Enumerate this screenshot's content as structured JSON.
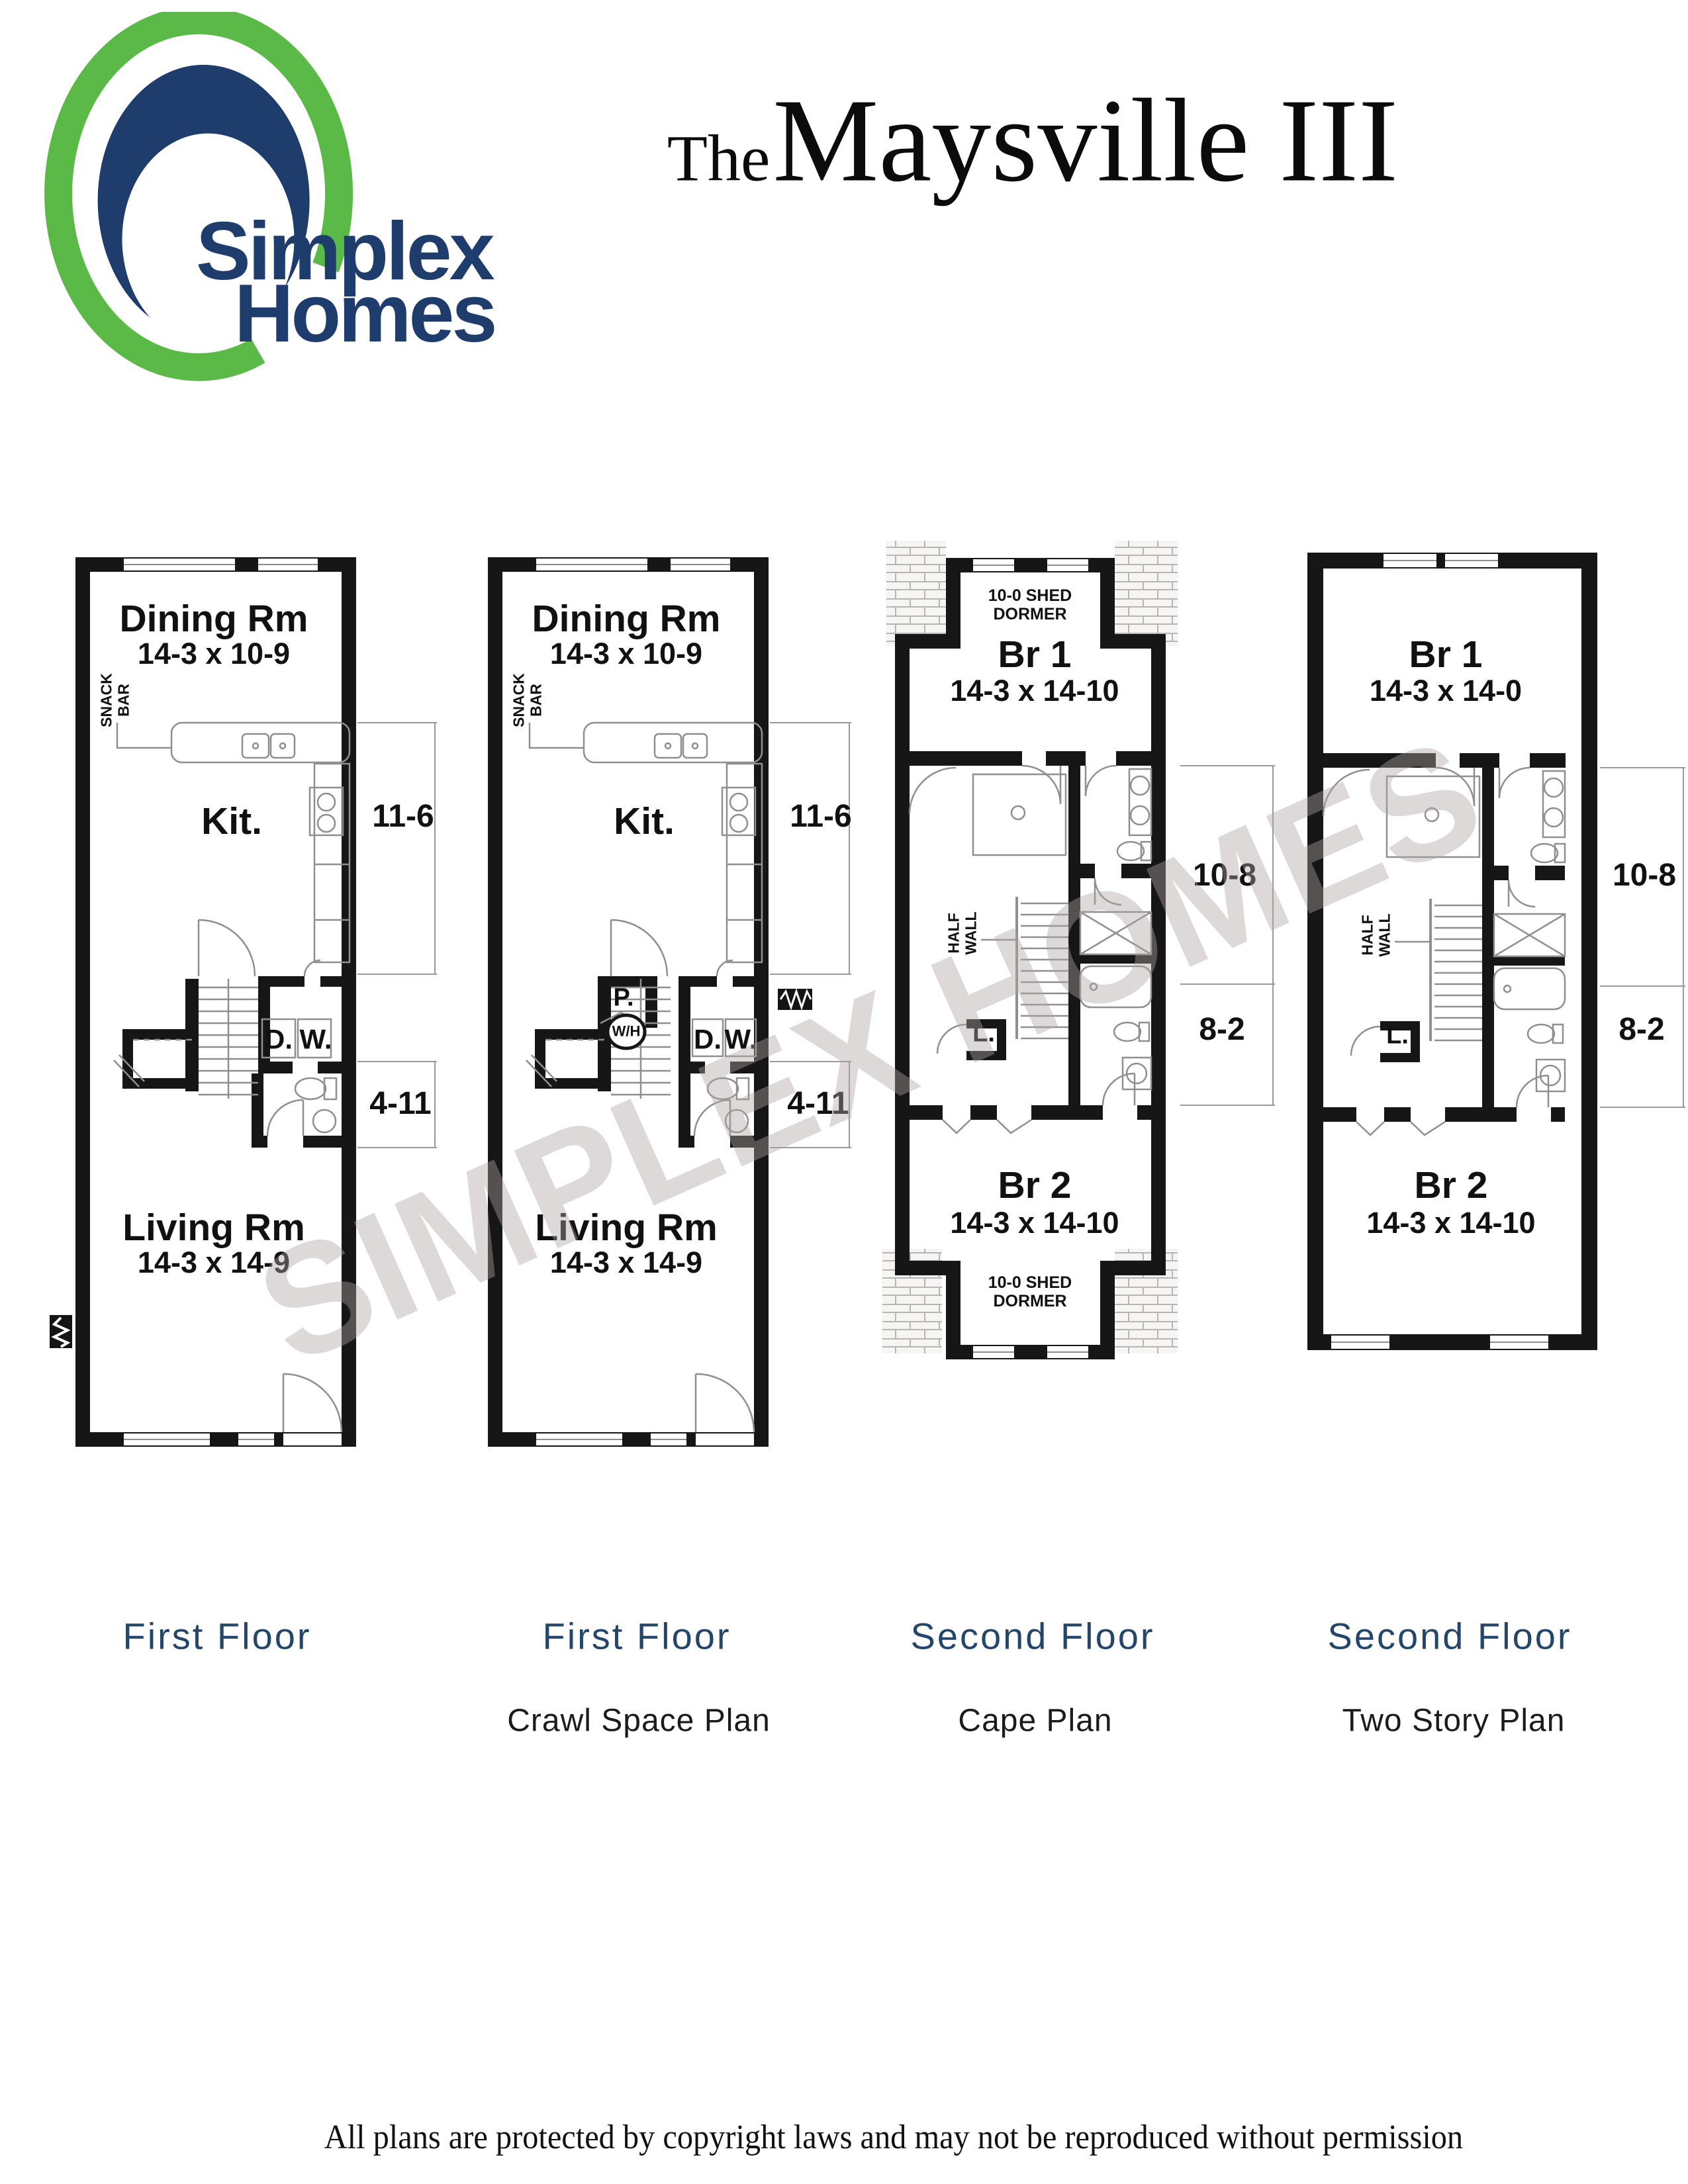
{
  "logo": {
    "word1": "Simplex",
    "word2": "Homes",
    "green": "#5bb948",
    "navy": "#1e3d6d"
  },
  "title": {
    "prefix": "The",
    "name": "Maysville III"
  },
  "watermark": "SIMPLEX HOMES",
  "footer": "All plans are protected by copyright laws and may not be reproduced without permission",
  "colors": {
    "wall_black": "#161616",
    "fixture_gray": "#8f8f8f",
    "caption_navy": "#24466b",
    "logo_green": "#5bb948",
    "logo_navy": "#1e3d6d",
    "watermark_gray": "#b0a6a6"
  },
  "plans": [
    {
      "id": "first-floor-a",
      "caption": "First Floor",
      "labels": {
        "dining": "Dining Rm",
        "dining_dims": "14-3 x 10-9",
        "snack_bar": "SNACK BAR",
        "kitchen": "Kit.",
        "dryer": "D.",
        "washer": "W.",
        "dim_kitchen": "11-6",
        "dim_bath": "4-11",
        "living": "Living Rm",
        "living_dims": "14-3 x 14-9"
      }
    },
    {
      "id": "first-floor-crawl-space",
      "caption": "First Floor",
      "subcaption": "Crawl Space Plan",
      "labels": {
        "dining": "Dining Rm",
        "dining_dims": "14-3 x 10-9",
        "snack_bar": "SNACK BAR",
        "kitchen": "Kit.",
        "pantry": "P.",
        "water_heater": "W/H",
        "dryer": "D.",
        "washer": "W.",
        "dim_kitchen": "11-6",
        "dim_bath": "4-11",
        "living": "Living Rm",
        "living_dims": "14-3 x 14-9"
      }
    },
    {
      "id": "second-floor-cape",
      "caption": "Second Floor",
      "subcaption": "Cape Plan",
      "labels": {
        "shed_dormer_top": "10-0 SHED DORMER",
        "br1": "Br 1",
        "br1_dims": "14-3 x 14-10",
        "half_wall": "HALF WALL",
        "linen": "L.",
        "dim_upper": "10-8",
        "dim_lower": "8-2",
        "br2": "Br 2",
        "br2_dims": "14-3 x 14-10",
        "shed_dormer_bottom": "10-0 SHED DORMER"
      }
    },
    {
      "id": "second-floor-two-story",
      "caption": "Second Floor",
      "subcaption": "Two Story Plan",
      "labels": {
        "br1": "Br 1",
        "br1_dims": "14-3 x 14-0",
        "half_wall": "HALF WALL",
        "linen": "L.",
        "dim_upper": "10-8",
        "dim_lower": "8-2",
        "br2": "Br 2",
        "br2_dims": "14-3 x 14-10"
      }
    }
  ]
}
